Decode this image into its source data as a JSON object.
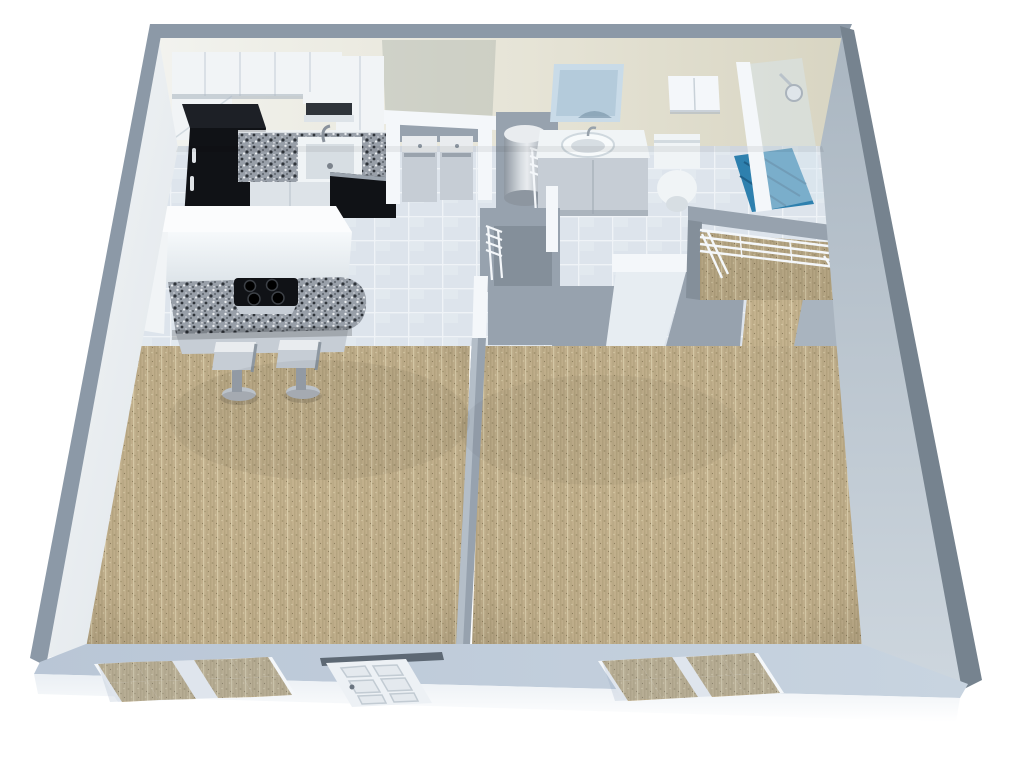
{
  "canvas": {
    "width": 1024,
    "height": 759,
    "description": "3D isometric cutaway floor plan render of a one-bedroom apartment, no text labels visible"
  },
  "rooms": [
    "kitchen",
    "living room",
    "bedroom",
    "bathroom",
    "walk-in closet",
    "hallway",
    "laundry alcove",
    "water heater closet",
    "entry closet"
  ],
  "fixtures": [
    "kitchen upper cabinets",
    "refrigerator",
    "microwave shelf",
    "kitchen sink with faucet",
    "granite countertop",
    "dishwasher / oven (black)",
    "breakfast bar island with cooktop (4 burners)",
    "two bar stools",
    "washer and dryer",
    "cylindrical water heater",
    "wire closet shelving",
    "bathroom vanity with sink and mirror",
    "medicine cabinet",
    "toilet",
    "corner glass shower with showerhead",
    "living room double window",
    "entry door (6-panel)",
    "bedroom double window"
  ],
  "colors": {
    "background": "#ffffff",
    "wall_edge": "#8c99a7",
    "wall_edge_dark": "#76838f",
    "far_wall_left": "#f2f3ef",
    "far_wall_mid": "#e7e5d8",
    "far_wall_right": "#d8d5c2",
    "laundry_wall_tint": "#b8bdb4",
    "left_wall_light": "#f4f6f7",
    "left_wall_dark": "#dfe5ea",
    "right_wall_dark": "#aab6c1",
    "right_wall_light": "#cdd6de",
    "front_wall_top_left": "#b9c6d6",
    "front_wall_top_right": "#c8d4e0",
    "front_wall_face": "#eaeff4",
    "tile_base": "#dde4ec",
    "tile_grout": "#eff3f7",
    "tile_light": "#e7edf2",
    "carpet_base": "#c4b28e",
    "carpet_dark": "#a3946f",
    "carpet_light": "#d9cca9",
    "carpet_stripe": "#b8a782",
    "interior_wall": "#97a2ae",
    "interior_wall_dark": "#848f9a",
    "interior_wall_light": "#a9b4bf",
    "white_trim": "#f4f7fa",
    "cabinet_white": "#f1f4f6",
    "cabinet_face": "#dde3e8",
    "cabinet_shadow": "#b7c1cb",
    "black_appliance": "#101216",
    "black_appliance_top": "#1d2026",
    "granite_base": "#989fa8",
    "granite_dark": "#2f343a",
    "granite_light": "#e9ecef",
    "steel": "#c6cdd5",
    "steel_dark": "#9aa3ad",
    "steel_light": "#e9ecef",
    "porcelain": "#f0f4f6",
    "porcelain_shadow": "#d7dee3",
    "mirror_light": "#c9dbe8",
    "mirror_dark": "#a7c0d2",
    "shower_blue": "#2e80ae",
    "shower_blue_dark": "#1e6089",
    "glass": "#d8e7f0",
    "door_header_dark": "#5d6874"
  }
}
